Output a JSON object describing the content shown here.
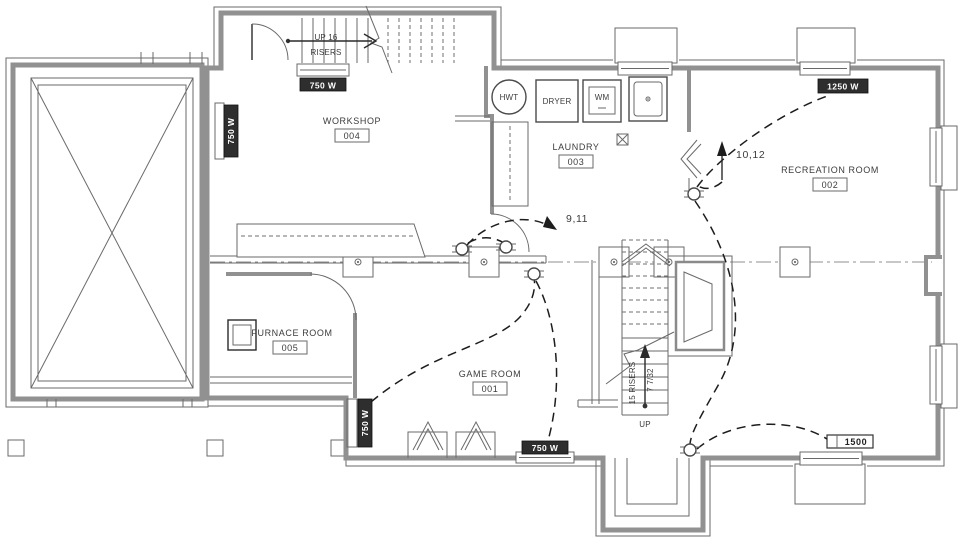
{
  "plan": {
    "rooms": {
      "workshop": {
        "name": "WORKSHOP",
        "number": "004"
      },
      "laundry": {
        "name": "LAUNDRY",
        "number": "003"
      },
      "recreation": {
        "name": "RECREATION ROOM",
        "number": "002"
      },
      "game": {
        "name": "GAME ROOM",
        "number": "001"
      },
      "furnace": {
        "name": "FURNACE ROOM",
        "number": "005"
      }
    },
    "appliances": {
      "hot_water_tank": "HWT",
      "dryer": "DRYER",
      "washing_machine": "WM"
    },
    "stairs": {
      "upper": {
        "line1": "UP 16",
        "line2": "RISERS"
      },
      "main": {
        "risers": "15 RISERS",
        "riser_height": "7 7/32",
        "direction": "UP"
      }
    },
    "circuits": {
      "game_room": "9,11",
      "recreation_room": "10,12"
    },
    "heaters": {
      "stair_hall": "750 W",
      "workshop_wall": "750 W",
      "game_room_wall": "750 W",
      "game_room_bottom": "750 W",
      "recreation_top": "1250 W",
      "recreation_bottom": "1500"
    },
    "colors": {
      "background": "#ffffff",
      "wall": "#919191",
      "line": "#555555",
      "text": "#3c3c3c",
      "circuit": "#1d1d1d",
      "heater_box": "#2e2e2e",
      "heater_text": "#ffffff"
    }
  }
}
